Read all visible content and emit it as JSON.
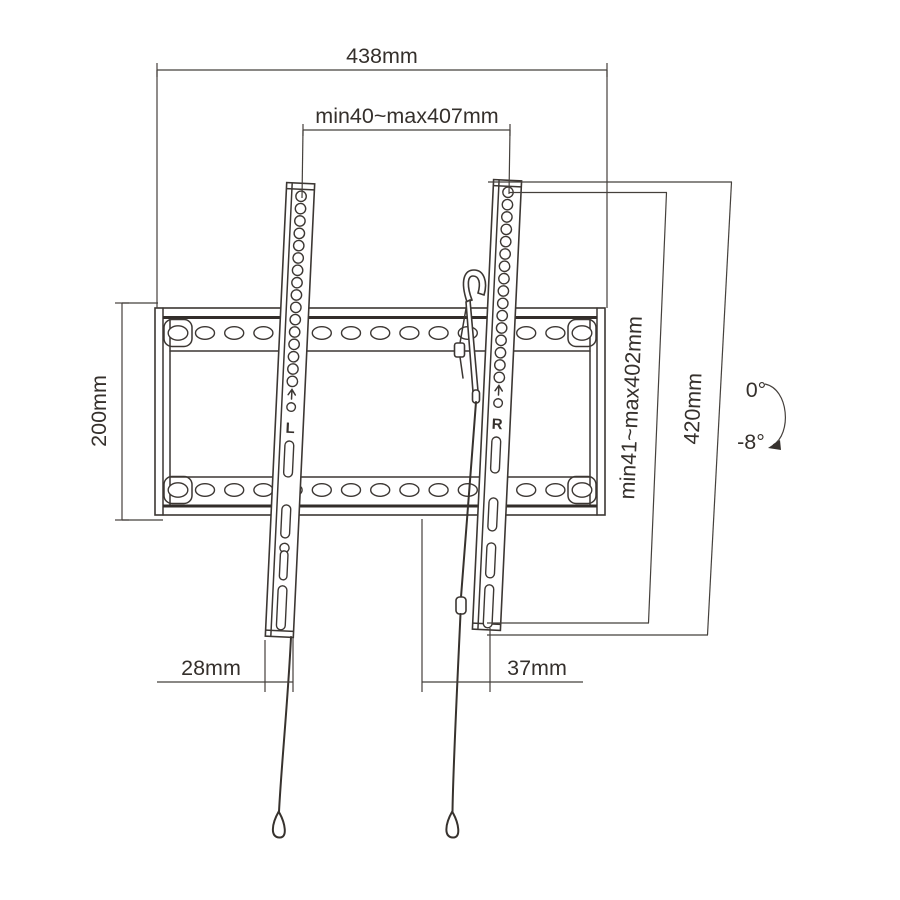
{
  "diagram": {
    "description": "Tilting TV wall mount bracket technical dimension drawing",
    "colors": {
      "background": "#ffffff",
      "line": "#3c3733",
      "text": "#35302c"
    },
    "dimensions": {
      "total_width": "438mm",
      "vesa_width_range": "min40~max407mm",
      "plate_height": "200mm",
      "bracket_slot_range": "min41~max402mm",
      "bracket_length": "420mm",
      "tilt_upper": "0°",
      "tilt_lower": "-8°",
      "bottom_left_offset": "28mm",
      "bottom_right_offset": "37mm"
    },
    "rail_labels": {
      "left": "L",
      "right": "R"
    }
  }
}
